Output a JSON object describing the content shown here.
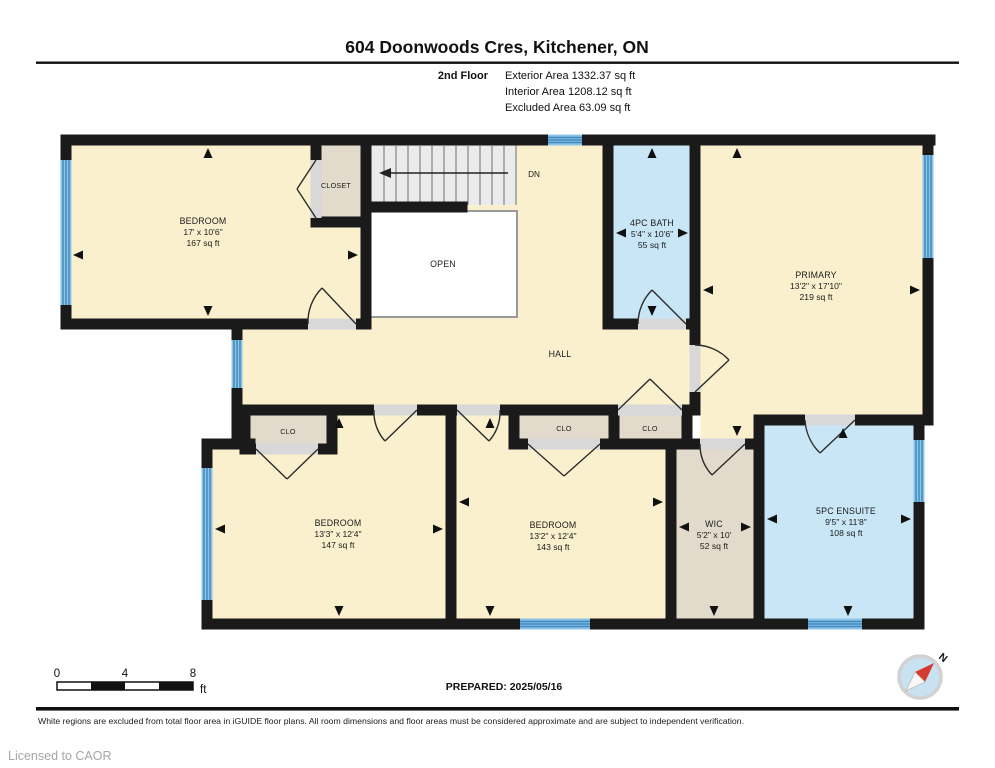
{
  "header": {
    "title": "604 Doonwoods Cres, Kitchener, ON",
    "floor_label": "2nd Floor",
    "stats": [
      "Exterior Area 1332.37 sq ft",
      "Interior Area 1208.12 sq ft",
      "Excluded Area 63.09 sq ft"
    ]
  },
  "rooms": {
    "bedroom_tl": {
      "name": "BEDROOM",
      "dims": "17' x 10'6\"",
      "area": "167 sq ft"
    },
    "closet": {
      "name": "CLOSET"
    },
    "stairs": {
      "label": "DN"
    },
    "open": {
      "name": "OPEN"
    },
    "hall": {
      "name": "HALL"
    },
    "bath": {
      "name": "4PC BATH",
      "dims": "5'4\" x 10'6\"",
      "area": "55 sq ft"
    },
    "primary": {
      "name": "PRIMARY",
      "dims": "13'2\" x 17'10\"",
      "area": "219 sq ft"
    },
    "clo_left": {
      "name": "CLO"
    },
    "clo_mid": {
      "name": "CLO"
    },
    "clo_right": {
      "name": "CLO"
    },
    "bedroom_bl": {
      "name": "BEDROOM",
      "dims": "13'3\" x 12'4\"",
      "area": "147 sq ft"
    },
    "bedroom_bm": {
      "name": "BEDROOM",
      "dims": "13'2\" x 12'4\"",
      "area": "143 sq ft"
    },
    "wic": {
      "name": "WIC",
      "dims": "5'2\" x 10'",
      "area": "52 sq ft"
    },
    "ensuite": {
      "name": "5PC ENSUITE",
      "dims": "9'5\" x 11'8\"",
      "area": "108 sq ft"
    }
  },
  "footer": {
    "scale_ticks": [
      "0",
      "4",
      "8"
    ],
    "scale_unit": "ft",
    "prepared": "PREPARED: 2025/05/16",
    "compass_label": "N",
    "disclaimer": "White regions are excluded from total floor area in iGUIDE floor plans. All room dimensions and floor areas must be considered approximate and are subject to independent verification.",
    "license": "Licensed to CAOR"
  },
  "colors": {
    "wall": "#1a1a1a",
    "floor": "#FAF0CE",
    "wet_room": "#C9E6F7",
    "closet": "#E2DACB",
    "window": "#8CC4E8",
    "window_stripe": "#3E87BC",
    "compass_needle": "#D63B30"
  }
}
